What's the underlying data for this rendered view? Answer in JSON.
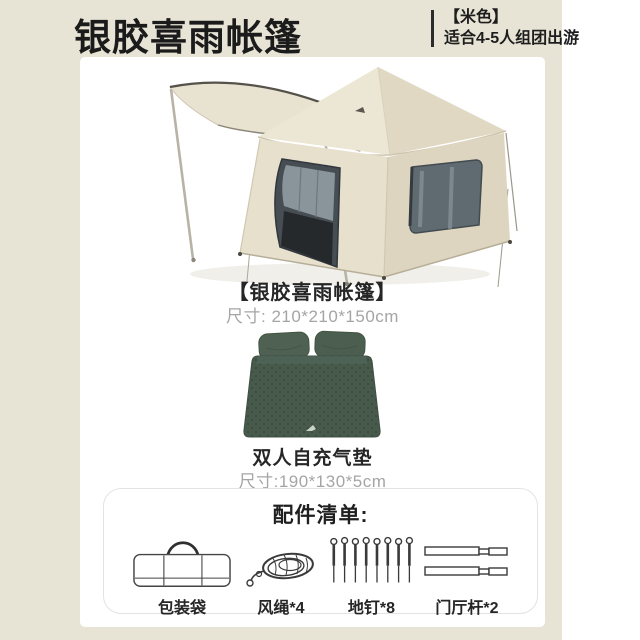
{
  "header": {
    "title": "银胶喜雨帐篷",
    "variant": "【米色】",
    "subtitle": "适合4-5人组团出游"
  },
  "tent": {
    "name": "【银胶喜雨帐篷】",
    "size": "尺寸: 210*210*150cm"
  },
  "mattress": {
    "name": "双人自充气垫",
    "size": "尺寸:190*130*5cm"
  },
  "accessories": {
    "title": "配件清单:",
    "items": [
      {
        "icon": "storage-bag-icon",
        "label": "包装袋"
      },
      {
        "icon": "wind-rope-icon",
        "label": "风绳*4"
      },
      {
        "icon": "ground-stake-icon",
        "label": "地钉*8"
      },
      {
        "icon": "canopy-pole-icon",
        "label": "门厅杆*2"
      }
    ]
  },
  "colors": {
    "card_background": "#e8e4d5",
    "panel_background": "#ffffff",
    "title_text": "#1b1b1b",
    "muted_text": "#a5a5a5",
    "tent_fabric": "#e8e2d0",
    "mattress_green": "#475a4c"
  }
}
